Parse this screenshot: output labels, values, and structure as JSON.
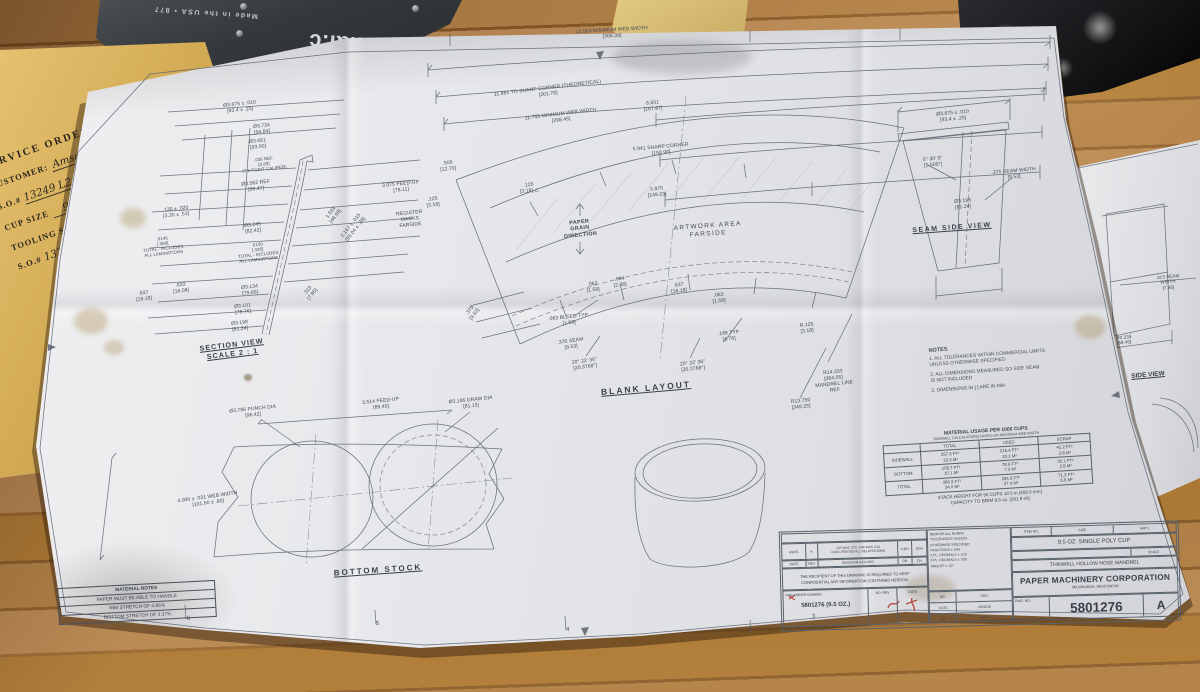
{
  "colors": {
    "paper": "#e7e8eb",
    "wood": "#a97943",
    "line": "#59626e",
    "red_markup": "#b23b2c",
    "envelope": "#d9b563"
  },
  "plate": {
    "brand": "ternational.c",
    "made_in": "Made in the USA • 877"
  },
  "envelope": {
    "heading": "SERVICE ORDER  (CLEAN",
    "customer_label": "CUSTOMER:",
    "customer_value": "Amscan",
    "so_label": "S.O.#",
    "so_value": "13249 L2",
    "item_label": "ITEM#",
    "item_value": "1",
    "cup_label": "CUP SIZE",
    "cup_value": "9 oz",
    "tooling_line": "TOOLING SPARE PARTS",
    "so2_label": "S.O.#",
    "so2_value": "13249 L2",
    "so2_item": "ITEM"
  },
  "sheet": {
    "titles": {
      "section": "SECTION VIEW\nSCALE 2 : 1",
      "blank": "BLANK LAYOUT",
      "bottom_stock": "BOTTOM STOCK",
      "seam_side": "SEAM SIDE VIEW",
      "paper_grain": "PAPER\nGRAIN\nDIRECTION",
      "artwork": "ARTWORK AREA\nFARSIDE"
    },
    "dims": [
      "Ø3.675 ± .010\n[93.4 ± .25]",
      "Ø3.734\n[94.84]",
      "Ø3.661\n[93.00]",
      ".036 REF\n[0.89]\n(7.5 POINT CALIPER)",
      "Ø3.562 REF\n[90.47]",
      ".130 ± .020\n[3.30 ± .51]",
      ".0145\n[.368]\nTOTAL - INCLUDES\nALL LAMINATIONS",
      "Ø3.245\n[82.42]",
      ".0130\n[.330]\nTOTAL - INCLUDES\nALL LAMINATIONS",
      "Ø3.134\n[79.60]",
      ".633\n[16.08]",
      ".637\n[16.18]",
      "Ø3.101\n[78.76]",
      "Ø3.198\n[81.24]",
      "1.834\n[46.58]",
      "2.167 ± .015\n[55.04 ± .38]",
      "3.075 FEED-UP\n[78.11]",
      "REGISTER MARKS\nFARSIDE",
      ".313\n[7.95]",
      "12.063 MINIMUM WEB WIDTH\n[306.39]",
      "11.881 TO SHARP CORNER (THEORETICAL)\n[301.78]",
      "11.750 MINIMUM WEB WIDTH\n[298.45]",
      "6.601\n[167.67]",
      "5.941 SHARP CORNER\n[150.90]",
      "5.875\n[149.23]",
      ".500\n[12.70]",
      ".125\n[3.18]",
      ".125\n[3.18] △",
      ".094\n[2.38]",
      ".637\n[16.18]",
      ".063\n[1.59]",
      ".063\n[1.59]",
      ".063 BLEED TYP.\n[1.59]",
      ".375\n[9.53]",
      ".375 SEAM\n[9.53]",
      "20° 22' 36\"\n[20.3768°]",
      "20° 22' 36\"\n[20.3768°]",
      ".188 TYP\n[4.76]",
      "R.125\n[3.18]",
      "R14.333\n[364.05]\nMANDREL LINE\nREF",
      "R13.750\n[349.25]",
      "Ø3.675 ± .010\n[93.4 ± .25]",
      "5° 30' 0\"\n[5.500°]",
      ".375 SEAM WIDTH\n[9.53]",
      "Ø3.198\n[81.24]",
      "Ø3.796 PUNCH DIA\n[96.42]",
      "3.514 FEED-UP\n[89.45]",
      "4.000 ± .031 WEB WIDTH\n[101.60 ± .80]",
      "Ø3.195 DRAW DIA\n[81.15]"
    ],
    "notes": {
      "title": "NOTES",
      "items": [
        "1. ALL TOLERANCES WITHIN COMMERCIAL LIMITS\nUNLESS OTHERWISE SPECIFIED",
        "2. ALL DIMENSIONS MEASURED SO SIDE SEAM\nIS NOT INCLUDED",
        "3. DIMENSIONS IN [ ] ARE IN MM"
      ]
    },
    "material_table": {
      "title": "MATERIAL USAGE PER 1000 CUPS",
      "subtitle": "SIDEWALL CALCULATIONS BASED ON MAXIMUM WEB WIDTH",
      "columns": [
        "TOTAL",
        "USED",
        "SCRAP"
      ],
      "rows": [
        {
          "label": "SIDEWALL",
          "total": "257.6 FT²\n23.9 M²",
          "used": "216.4 FT²\n20.1 M²",
          "scrap": "41.2 FT²\n3.8 M²"
        },
        {
          "label": "BOTTOM",
          "total": "108.7 FT²\n10.1 M²",
          "used": "78.6 FT²\n7.3 M²",
          "scrap": "30.1 FT²\n2.8 M²"
        },
        {
          "label": "TOTAL",
          "total": "366.3 FT²\n34.0 M²",
          "used": "294.9 FT²\n27.4 M²",
          "scrap": "71.3 FT²\n6.6 M²"
        }
      ],
      "footer": [
        "STACK HEIGHT FOR 50 CUPS 18.5 in [469.5 mm]",
        "CAPACITY TO BRIM 9.5 oz. [281.9 ml]"
      ]
    },
    "material_notes": {
      "title": "MATERIAL NOTES",
      "lines": [
        "PAPER MUST BE ABLE TO HANDLE",
        "RIM STRETCH OF 4.85%",
        "BOTTOM STRETCH OF 3.37%"
      ]
    },
    "zone_numbers": [
      "6",
      "5",
      "4",
      "3"
    ],
    "title_block": {
      "rev_date": "4/9/15",
      "rev_letter_row": "A",
      "rev_desc": ".125 WAS .375, .040 WAS .010\n.0130 UPDATED ALL RELATED DIMS",
      "rev_by": "KDH",
      "rev_ch": "KDH",
      "hdr_date": "DATE",
      "hdr_rev": "REV",
      "hdr_record": "REVISION RECORD",
      "hdr_dr": "DR.",
      "hdr_ch": "CH.",
      "confidential": "THE RECIPIENT OF THIS DRAWING IS REQUIRED TO KEEP\nCONFIDENTIAL ANY INFORMATION CONTAINED HEREON.",
      "order_label": "PMC ORDER NUMBER",
      "order_value": "5801276 (9.5 OZ.)",
      "no_rev_label": "NO. REV",
      "date_label": "DATE",
      "tol_lines": [
        "REMOVE ALL BURRS",
        "TOLERANCES UNLESS",
        "OTHERWISE SPECIFIED:",
        "FRACTIONS ± 1/64",
        "2 PL. DECIMALS ± .010",
        "3 PL. DECIMALS ± .005",
        "ANGLES ± 1/2°"
      ],
      "sign": [
        [
          "DR.",
          "KDH"
        ],
        [
          "DATE",
          "4/9/2015"
        ],
        [
          "CH.",
          "APP'D"
        ]
      ],
      "item_no_label": "ITEM NO.",
      "size_label": "SIZE",
      "matl_label": "MAT'L",
      "item_name": "9.5 OZ. SINGLE POLY CUP",
      "scale_label": "SCALE",
      "mandrel": "THINWALL HOLLOW NOSE MANDREL",
      "company": "PAPER MACHINERY CORPORATION",
      "city": "MILWAUKEE, WISCONSIN",
      "dwg_label": "DWG. NO.",
      "dwg_number": "5801276",
      "rev_letter": "A"
    }
  },
  "sheet2": {
    "dim_seam": ".313 SEAM WIDTH\n[7.95]",
    "dim_dia": "Ø2.339\n[59.40]",
    "label": "SIDE VIEW"
  }
}
